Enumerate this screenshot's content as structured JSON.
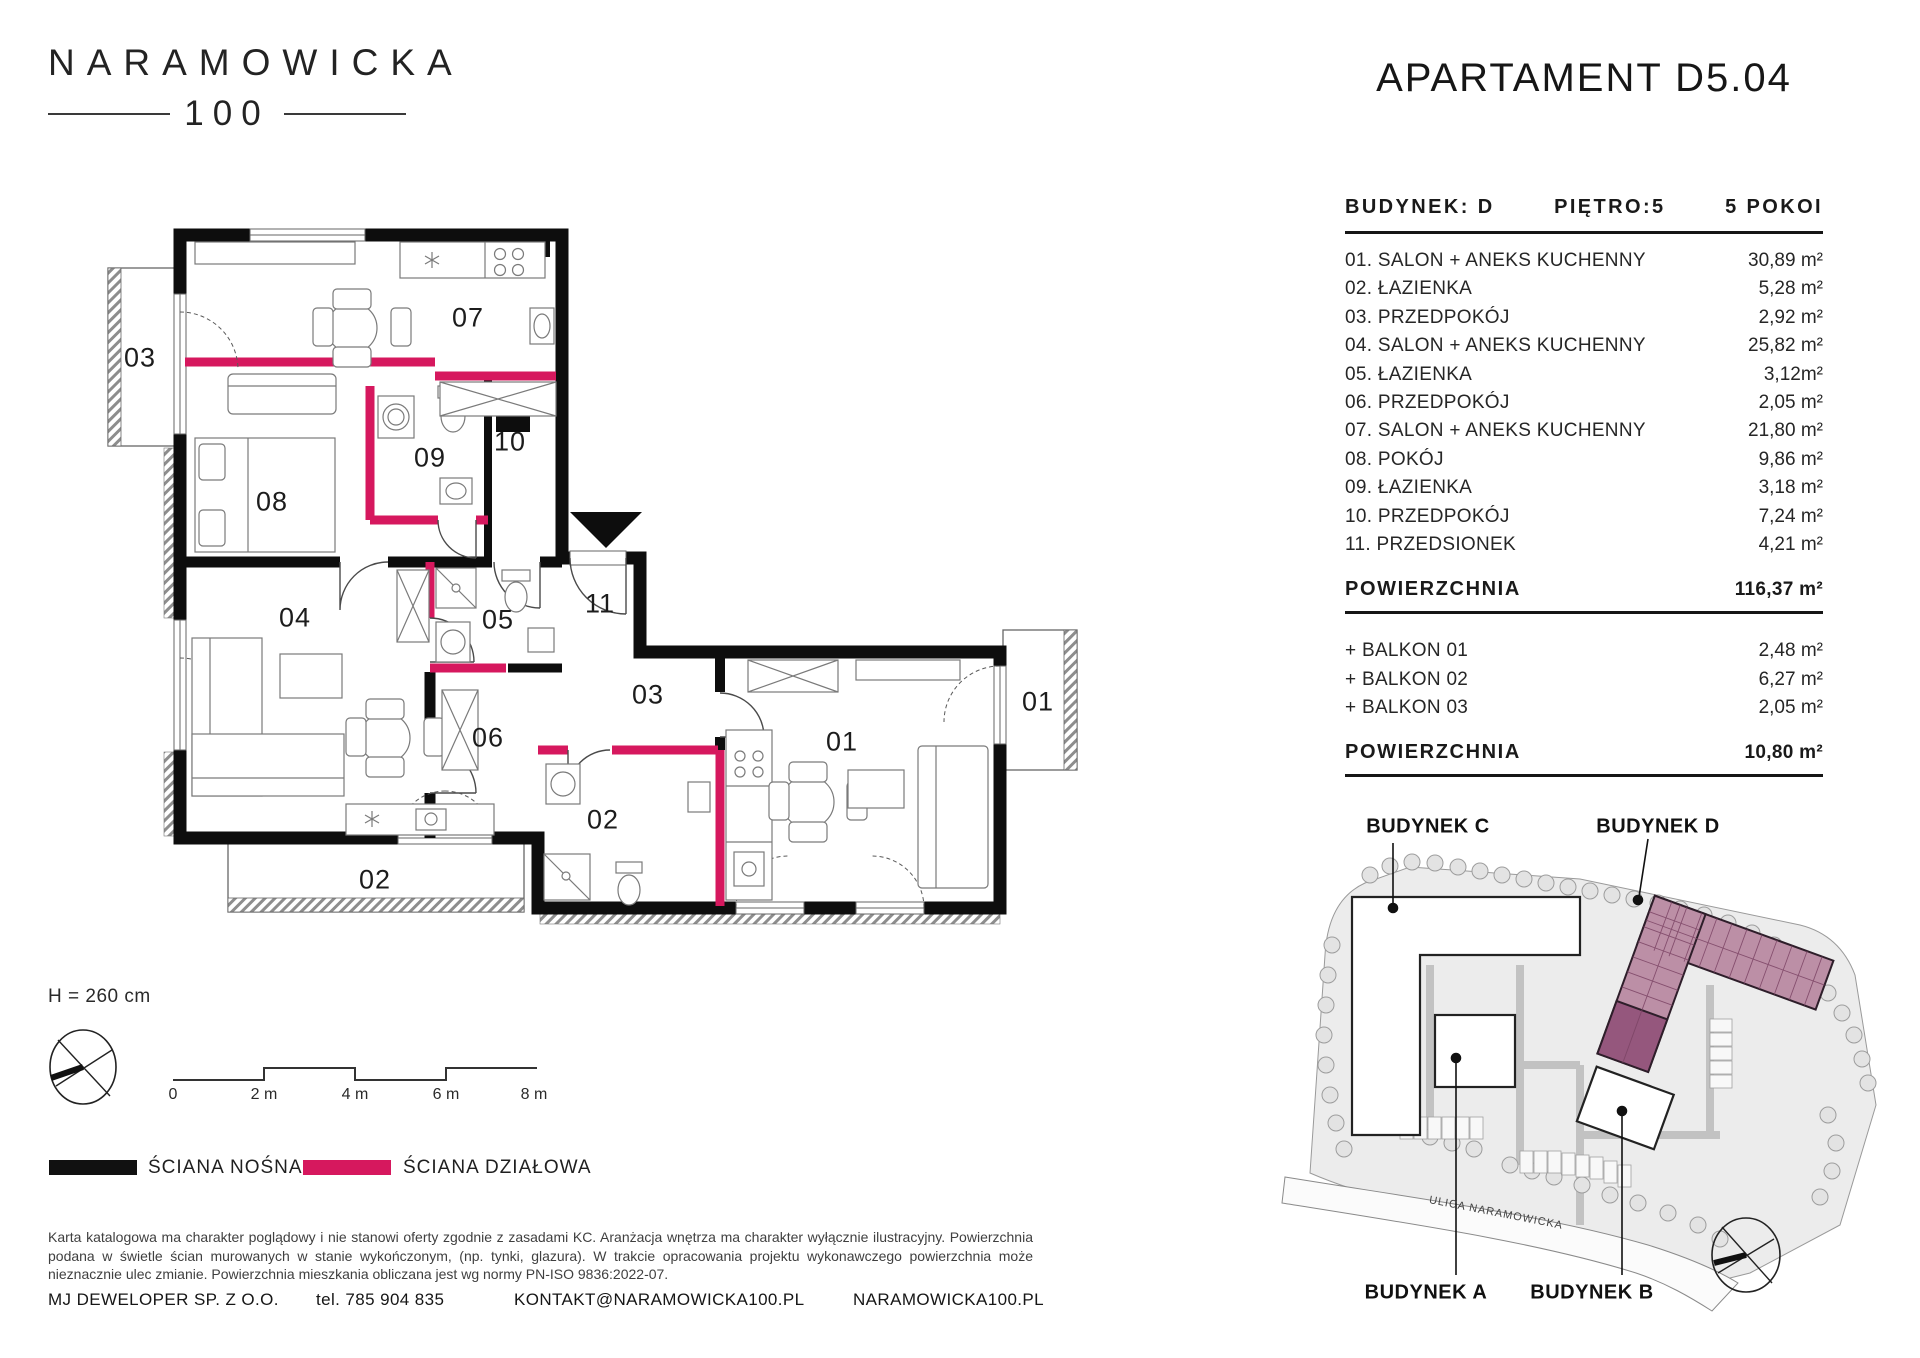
{
  "header": {
    "logo_line1": "NARAMOWICKA",
    "logo_line2": "100",
    "title": "APARTAMENT D5.04"
  },
  "spec": {
    "building_label": "BUDYNEK: D",
    "floor_label": "PIĘTRO:5",
    "rooms_count_label": "5 POKOI",
    "rooms": [
      {
        "name": "01. SALON + ANEKS KUCHENNY",
        "area": "30,89 m²"
      },
      {
        "name": "02. ŁAZIENKA",
        "area": "5,28 m²"
      },
      {
        "name": "03. PRZEDPOKÓJ",
        "area": "2,92 m²"
      },
      {
        "name": "04. SALON + ANEKS KUCHENNY",
        "area": "25,82 m²"
      },
      {
        "name": "05. ŁAZIENKA",
        "area": "3,12m²"
      },
      {
        "name": "06. PRZEDPOKÓJ",
        "area": "2,05 m²"
      },
      {
        "name": "07. SALON + ANEKS KUCHENNY",
        "area": "21,80 m²"
      },
      {
        "name": "08. POKÓJ",
        "area": "9,86 m²"
      },
      {
        "name": "09. ŁAZIENKA",
        "area": "3,18 m²"
      },
      {
        "name": "10. PRZEDPOKÓJ",
        "area": "7,24 m²"
      },
      {
        "name": "11. PRZEDSIONEK",
        "area": "4,21 m²"
      }
    ],
    "total_label": "POWIERZCHNIA",
    "total_area": "116,37 m²",
    "balconies": [
      {
        "name": "+ BALKON 01",
        "area": "2,48 m²"
      },
      {
        "name": "+ BALKON 02",
        "area": "6,27 m²"
      },
      {
        "name": "+ BALKON 03",
        "area": "2,05 m²"
      }
    ],
    "balcony_total_label": "POWIERZCHNIA",
    "balcony_total_area": "10,80 m²"
  },
  "plan": {
    "rooms": {
      "r01": "01",
      "r02": "02",
      "r03": "03",
      "r04": "04",
      "r05": "05",
      "r06": "06",
      "r07": "07",
      "r08": "08",
      "r09": "09",
      "r10": "10",
      "r11": "11"
    },
    "balconies": {
      "b01": "01",
      "b02": "02",
      "b03": "03"
    },
    "height_label": "H = 260 cm",
    "scale": {
      "t0": "0",
      "t2": "2 m",
      "t4": "4 m",
      "t6": "6 m",
      "t8": "8 m"
    }
  },
  "legend": {
    "load_bearing": "ŚCIANA NOŚNA",
    "partition": "ŚCIANA DZIAŁOWA",
    "colors": {
      "load_bearing": "#111111",
      "partition": "#d6185e"
    }
  },
  "disclaimer": "Karta katalogowa ma charakter poglądowy i nie stanowi oferty zgodnie z zasadami KC. Aranżacja wnętrza ma charakter wyłącznie ilustracyjny. Powierzchnia podana w świetle ścian murowanych w stanie wykończonym, (np. tynki, glazura). W trakcie opracowania projektu wykonawczego powierzchnia może nieznacznie ulec zmianie. Powierzchnia mieszkania obliczana jest wg normy PN-ISO 9836:2022-07.",
  "footer": {
    "company": "MJ DEWELOPER SP. Z O.O.",
    "phone": "tel. 785 904 835",
    "email": "KONTAKT@NARAMOWICKA100.PL",
    "website": "NARAMOWICKA100.PL"
  },
  "sitemap": {
    "building_a": "BUDYNEK A",
    "building_b": "BUDYNEK B",
    "building_c": "BUDYNEK C",
    "building_d": "BUDYNEK D",
    "street": "ULICA NARAMOWICKA"
  }
}
